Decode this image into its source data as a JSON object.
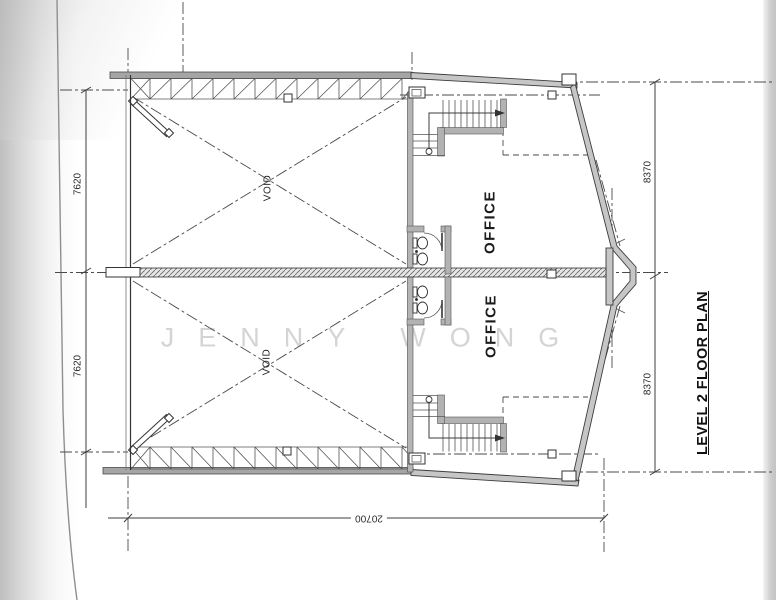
{
  "page": {
    "title": "LEVEL 2 FLOOR PLAN",
    "watermark": "JENNY WONG"
  },
  "rooms": {
    "office_upper": "OFFICE",
    "office_lower": "OFFICE",
    "void_upper": "VOID",
    "void_lower": "VOID"
  },
  "dimensions": {
    "left_upper": "7620",
    "left_lower": "7620",
    "right_upper": "8370",
    "right_lower": "8370",
    "bottom": "20700"
  },
  "colors": {
    "line": "#3d3d3d",
    "wall_fill": "#c6c6c6",
    "paper": "#ffffff",
    "watermark": "#d4d4d4"
  }
}
